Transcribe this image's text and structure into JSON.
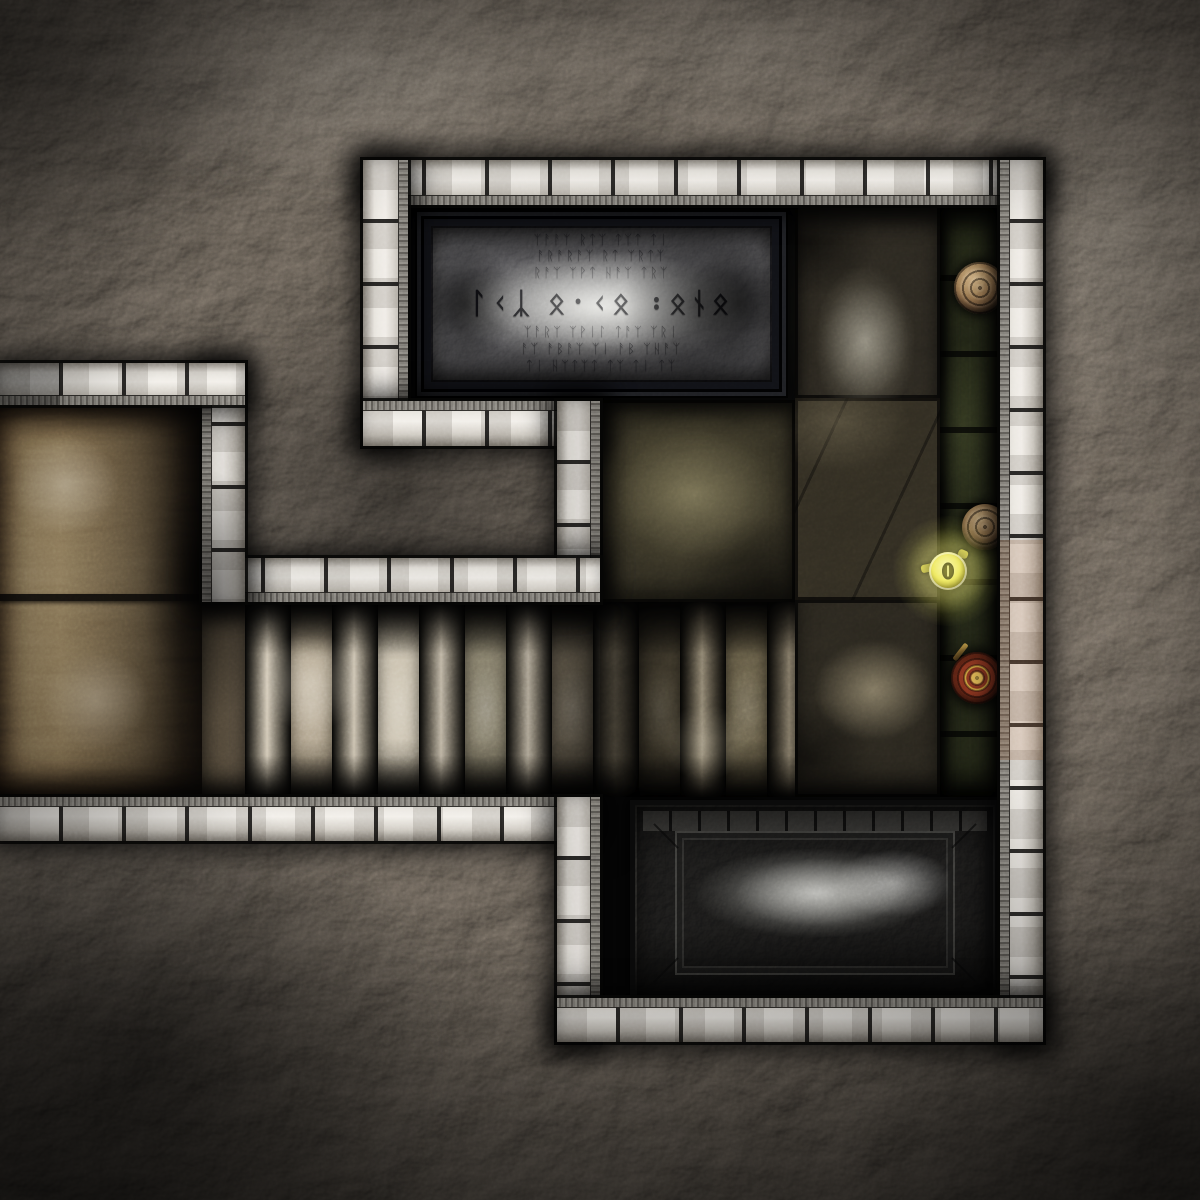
{
  "meta": {
    "title": "Top-down dungeon map tile: stone chambers with rune tablet, grand staircase and crypt slab",
    "tile_size_px": 1200,
    "visible_text_language": "runic inscription"
  },
  "runes": {
    "rows": [
      "ᛉᚨᚨᛉ ᚱᛏᛉ ᛏᛉᛏ ᛏᛁ",
      "ᚨᚱᚨᚱᚨᛉ ᚱᛏ ᛉᚱᛏᛉ",
      "ᚱᚨᛉ ᛉᚹᛏ ᚺᚨᛉ ᛏᚱᛉ",
      "ᛚᚲᛣ ᛟ᛫ᚲᛟ ᛬ᛟᚾᛟ",
      "ᛉᚨᚱᛉ ᛉᚹᛁᛚ ᛏᚨᛉ ᛉᚱᛁ",
      "ᚨᛉ ᚨᛒᚨᛉ ᛉᛁ ᚨᛒ ᛉᚺᚨᛉ",
      "ᛏᛁ ᚺᛉᛏᛉᛏ ᛏᛉ ᛏᛁ ᛏᛉ"
    ],
    "emphasis_row": 3
  },
  "rooms": [
    {
      "id": "rune-tablet-chamber",
      "label": "chamber with engraved rune tablet"
    },
    {
      "id": "eastern-hall",
      "label": "eastern hall with stone tile floor"
    },
    {
      "id": "mossy-ledge",
      "label": "narrow mossy ledge along east wall"
    },
    {
      "id": "grand-staircase",
      "label": "wide staircase descending east"
    },
    {
      "id": "western-chamber",
      "label": "western chamber with tan stone floor"
    },
    {
      "id": "crypt-recess",
      "label": "southern recess with carved slab"
    }
  ],
  "objects": [
    {
      "id": "rune-tablet",
      "label": "engraved stone rune tablet"
    },
    {
      "id": "stone-slab",
      "label": "carved crypt slab"
    },
    {
      "id": "clay-pot-upper",
      "label": "clay pot"
    },
    {
      "id": "clay-pot-lower",
      "label": "clay pot"
    },
    {
      "id": "yellow-lantern",
      "label": "glowing yellow lantern"
    },
    {
      "id": "ornate-shield",
      "label": "ornate round shield with gold rings"
    }
  ],
  "stairs": {
    "orientation": "horizontal",
    "step_count": 7,
    "cylinder_brightness": [
      1.0,
      0.96,
      0.9,
      0.82,
      0.78,
      0.72,
      0.64
    ],
    "tread_colors": [
      "#b9ae9c",
      "#d2cbbd",
      "#8f8a7a",
      "#6d665a",
      "#5e594e",
      "#7a7464",
      "#4e4a40"
    ]
  },
  "colors": {
    "wall_stone": "#e9e5de",
    "mortar": "#141210",
    "rock_dark": "#1c1916",
    "floor_tan": "#9a8a70",
    "tile_dark": "#3c392e",
    "moss_green": "#2a2f1f",
    "lantern_yellow": "#e8e049",
    "lantern_glow": "#ebe66e",
    "shield_rust": "#8a3520",
    "shield_gold": "#c89c3e",
    "pot_clay": "#9c7a52",
    "slab_grey": "#8f8d86"
  }
}
